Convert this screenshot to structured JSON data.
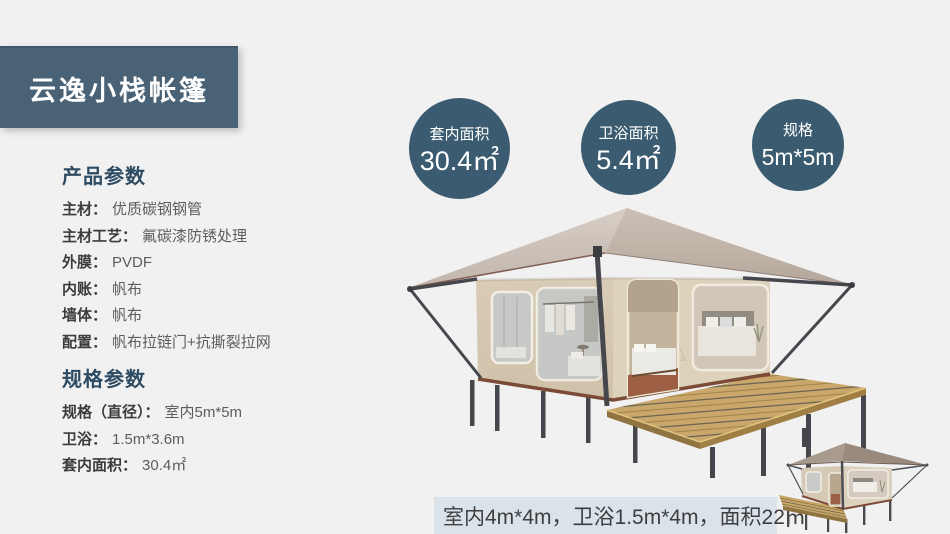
{
  "banner": {
    "title": "云逸小栈帐篷",
    "bg": "#4a6275"
  },
  "stats": [
    {
      "label": "套内面积",
      "value": "30.4㎡"
    },
    {
      "label": "卫浴面积",
      "value": "5.4㎡"
    },
    {
      "label": "规格",
      "value": "5m*5m"
    }
  ],
  "product_params": {
    "heading": "产品参数",
    "rows": [
      {
        "label": "主材：",
        "value": "优质碳钢钢管"
      },
      {
        "label": "主材工艺：",
        "value": "氟碳漆防锈处理"
      },
      {
        "label": "外膜：",
        "value": "PVDF"
      },
      {
        "label": "内账：",
        "value": "帆布"
      },
      {
        "label": "墙体：",
        "value": "帆布"
      },
      {
        "label": "配置：",
        "value": "帆布拉链门+抗撕裂拉网"
      }
    ]
  },
  "spec_params": {
    "heading": "规格参数",
    "rows": [
      {
        "label": "规格（直径）：",
        "value": "室内5m*5m"
      },
      {
        "label": "卫浴：",
        "value": "1.5m*3.6m"
      },
      {
        "label": "套内面积：",
        "value": "30.4㎡"
      }
    ]
  },
  "footnote": {
    "text": "室内4m*4m，卫浴1.5m*4m，面积22㎡",
    "bg": "#dbe3ea"
  },
  "colors": {
    "page_bg": "#f1f1f2",
    "banner_bg": "#4a6275",
    "circle_bg": "#3b5c70",
    "heading_text": "#2d4b63",
    "footnote_bg": "#dbe3ea",
    "roof": "#c9bdb3",
    "canvas_wall": "#d8ccb7",
    "deck_wood": "#c9a76a",
    "frame_metal": "#46474c"
  }
}
